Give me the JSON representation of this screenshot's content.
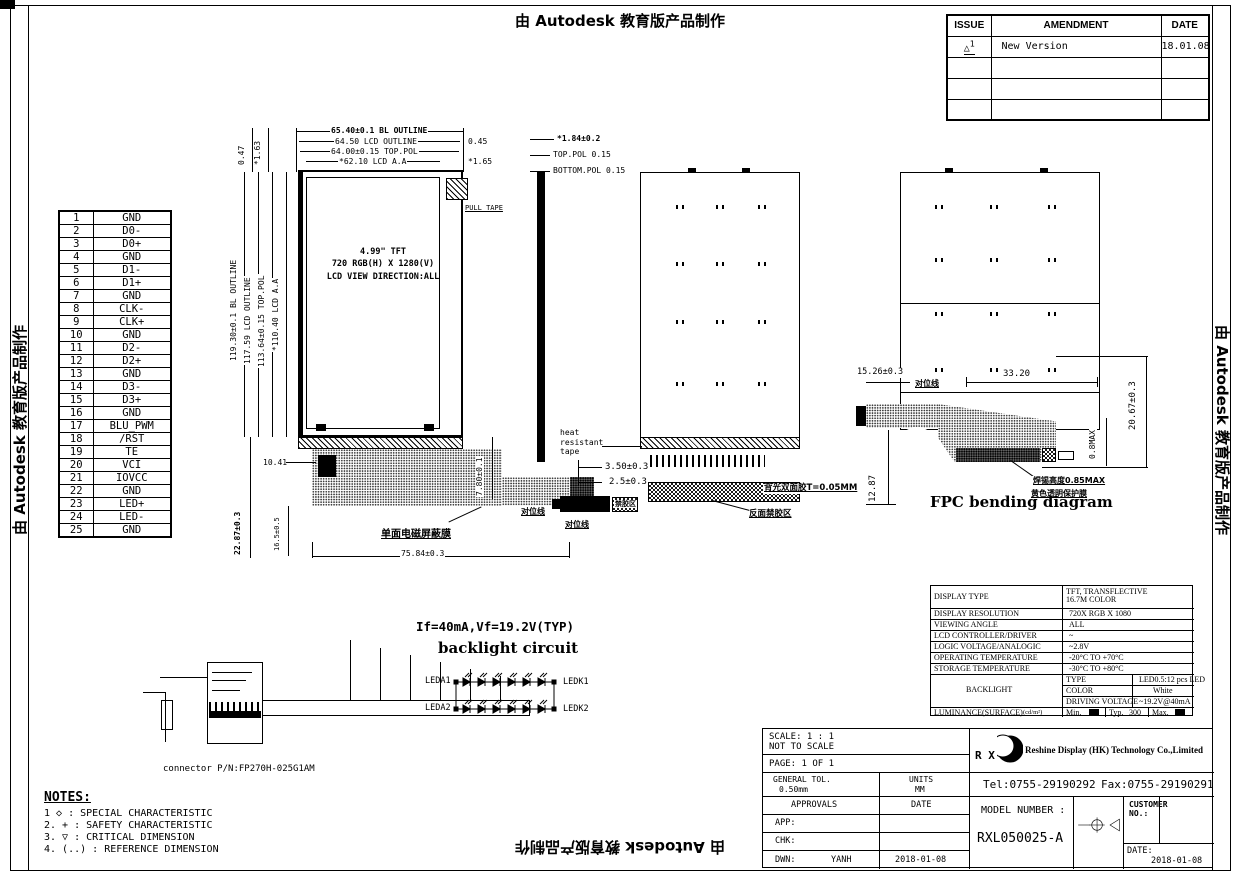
{
  "sheet": {
    "watermark": "由 Autodesk 教育版产品制作"
  },
  "revision_table": {
    "headers": [
      "ISSUE",
      "AMENDMENT",
      "DATE"
    ],
    "issue_icon": "triangle-delta",
    "rows": [
      {
        "issue": "1",
        "amendment": "New Version",
        "date": "18.01.08"
      },
      {
        "issue": "",
        "amendment": "",
        "date": ""
      },
      {
        "issue": "",
        "amendment": "",
        "date": ""
      },
      {
        "issue": "",
        "amendment": "",
        "date": ""
      }
    ]
  },
  "pin_table": {
    "pins": [
      {
        "no": "1",
        "name": "GND"
      },
      {
        "no": "2",
        "name": "D0-"
      },
      {
        "no": "3",
        "name": "D0+"
      },
      {
        "no": "4",
        "name": "GND"
      },
      {
        "no": "5",
        "name": "D1-"
      },
      {
        "no": "6",
        "name": "D1+"
      },
      {
        "no": "7",
        "name": "GND"
      },
      {
        "no": "8",
        "name": "CLK-"
      },
      {
        "no": "9",
        "name": "CLK+"
      },
      {
        "no": "10",
        "name": "GND"
      },
      {
        "no": "11",
        "name": "D2-"
      },
      {
        "no": "12",
        "name": "D2+"
      },
      {
        "no": "13",
        "name": "GND"
      },
      {
        "no": "14",
        "name": "D3-"
      },
      {
        "no": "15",
        "name": "D3+"
      },
      {
        "no": "16",
        "name": "GND"
      },
      {
        "no": "17",
        "name": "BLU_PWM"
      },
      {
        "no": "18",
        "name": "/RST"
      },
      {
        "no": "19",
        "name": "TE"
      },
      {
        "no": "20",
        "name": "VCI"
      },
      {
        "no": "21",
        "name": "IOVCC"
      },
      {
        "no": "22",
        "name": "GND"
      },
      {
        "no": "23",
        "name": "LED+"
      },
      {
        "no": "24",
        "name": "LED-"
      },
      {
        "no": "25",
        "name": "GND"
      }
    ]
  },
  "front_view": {
    "top_dims": [
      "65.40±0.1 BL OUTLINE",
      "64.50 LCD OUTLINE",
      "64.00±0.15 TOP.POL",
      "*62.10 LCD A.A"
    ],
    "offset_right_1": "0.45",
    "offset_right_2": "*1.65",
    "offset_left_1": "0.47",
    "offset_left_2": "*1.63",
    "left_dims": [
      "119.30±0.1 BL OUTLINE",
      "117.59 LCD OUTLINE",
      "113.64±0.15 TOP.POL",
      "*110.40 LCD A.A"
    ],
    "panel_lines": [
      "4.99\" TFT",
      "720 RGB(H) X 1280(V)",
      "LCD VIEW DIRECTION:ALL"
    ],
    "pull_tape": "PULL TAPE",
    "dim_fpc_height": "22.87±0.3",
    "dim_fpc_inner": "16.5±0.5",
    "dim_stiffener": "10.41",
    "dim_connector_height": "7.80±0.1",
    "dim_fpc_width": "75.84±0.3",
    "shield_film": "单面电磁屏蔽膜",
    "align_mark": "对位线"
  },
  "section_view": {
    "dim_thickness": "*1.84±0.2",
    "top_pol": "TOP.POL 0.15",
    "bottom_pol": "BOTTOM.POL 0.15"
  },
  "back_view": {
    "heat_tape": [
      "heat",
      "resistant",
      "tape"
    ],
    "dim_3_50": "3.50±0.3",
    "dim_2_5": "2.5±0.3",
    "tape_note": "背光双面胶T=0.05MM",
    "no_glue_back": "反面禁胶区",
    "no_glue": "禁胶区",
    "align_mark": "对位线"
  },
  "bending_diagram": {
    "title": "FPC bending diagram",
    "dim_tail": "15.26±0.3",
    "dim_span": "33.20",
    "dim_height": "20.67±0.3",
    "dim_depth": "12.87",
    "dim_clearance": "0.8MAX",
    "align_mark": "对位线",
    "note_line1": "焊锡高度0.85MAX",
    "note_line2": "黄色透明保护膜"
  },
  "backlight_circuit": {
    "spec": "If=40mA,Vf=19.2V(TYP)",
    "title": "backlight circuit",
    "leds_per_row": 6,
    "rows": [
      {
        "anode": "LEDA1",
        "cathode": "LEDK1"
      },
      {
        "anode": "LEDA2",
        "cathode": "LEDK2"
      }
    ]
  },
  "connector": {
    "part_number": "connector P/N:FP270H-025G1AM"
  },
  "notes": {
    "title": "NOTES:",
    "items": [
      "1 ◇ : SPECIAL CHARACTERISTIC",
      "2. + : SAFETY CHARACTERISTIC",
      "3. ▽ : CRITICAL DIMENSION",
      "4. (..) : REFERENCE DIMENSION"
    ]
  },
  "spec_table": {
    "rows": [
      {
        "label": "DISPLAY TYPE",
        "value": "TFT, TRANSFLECTIVE\n16.7M COLOR"
      },
      {
        "label": "DISPLAY RESOLUTION",
        "value": "720X RGB X 1080"
      },
      {
        "label": "VIEWING ANGLE",
        "value": "ALL"
      },
      {
        "label": "LCD CONTROLLER/DRIVER",
        "value": "~"
      },
      {
        "label": "LOGIC VOLTAGE/ANALOGIC",
        "value": "~2.8V"
      },
      {
        "label": "OPERATING TEMPERATURE",
        "value": "-20°C TO +70°C"
      },
      {
        "label": "STORAGE TEMPERATURE",
        "value": "-30°C TO +80°C"
      }
    ],
    "backlight_label": "BACKLIGHT",
    "backlight_rows": [
      {
        "label": "TYPE",
        "value": "LED0.5:12 pcs LED"
      },
      {
        "label": "COLOR",
        "value": "White"
      },
      {
        "label": "DRIVING VOLTAGE",
        "value": "~19.2V@40mA"
      }
    ],
    "luminance_label": "LUMINANCE(SURFACE)",
    "luminance_unit": "(cd/m²)",
    "lum_min_label": "Min.",
    "lum_typ_label": "Typ.",
    "lum_typ_value": "300",
    "lum_max_label": "Max."
  },
  "title_block": {
    "scale1": "SCALE: 1 : 1",
    "scale2": "NOT TO SCALE",
    "page": "PAGE: 1 OF 1",
    "tol_label": "GENERAL TOL.",
    "tol_value": "0.50mm",
    "units_label": "UNITS",
    "units_value": "MM",
    "logo_text": "R X",
    "company": "Reshine Display (HK) Technology Co.,Limited",
    "tel": "Tel:0755-29190292",
    "fax": "Fax:0755-29190291",
    "approvals": "APPROVALS",
    "date_hdr": "DATE",
    "app": "APP:",
    "chk": "CHK:",
    "dwn": "DWN:",
    "dwn_name": "YANH",
    "dwn_date": "2018-01-08",
    "model_label": "MODEL NUMBER :",
    "model_value": "RXL050025-A",
    "customer_label": "CUSTOMER\nNO.:",
    "date_label": "DATE:",
    "date_value": "2018-01-08"
  }
}
